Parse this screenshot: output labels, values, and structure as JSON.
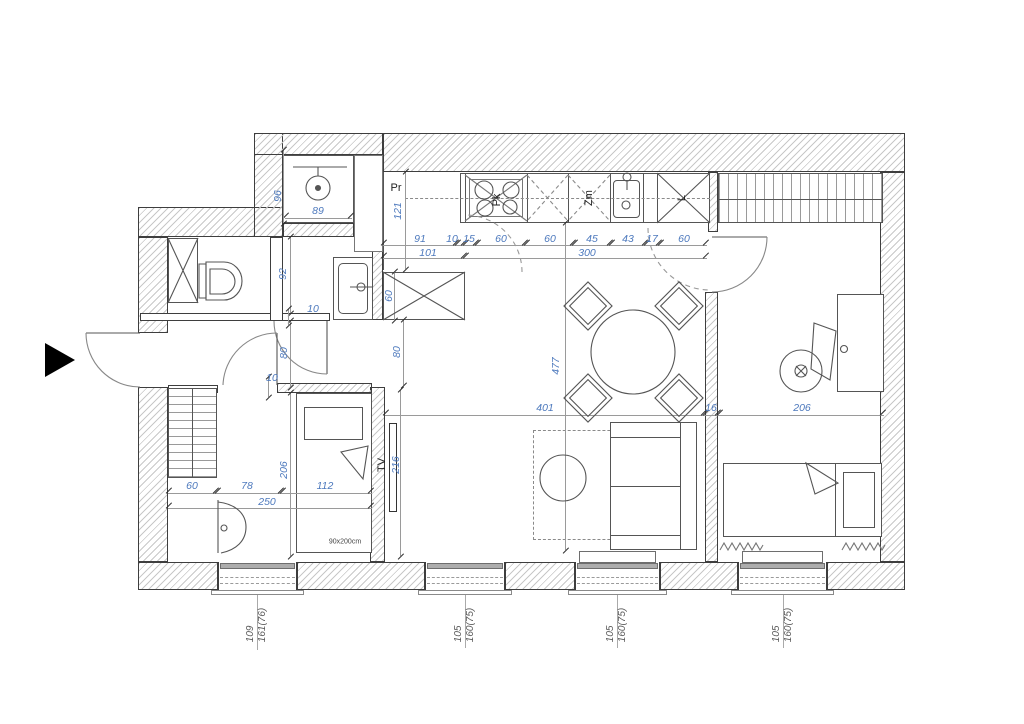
{
  "drawing": {
    "type": "apartment floor plan",
    "bed_size_label": "90x200cm"
  },
  "colors": {
    "dimension_text": "#4d79bd",
    "wall_outline": "#3e3e3e",
    "hatch": "#c8c8c8",
    "window_label_text": "#5a5a5a"
  },
  "annotations": [
    {
      "n": "dim-shower-height",
      "t": "96",
      "x": 278,
      "y": 196,
      "r": 1,
      "c": "b"
    },
    {
      "n": "dim-shower-width",
      "t": "89",
      "x": 318,
      "y": 211,
      "r": 0,
      "c": "b"
    },
    {
      "n": "dim-wc-depth",
      "t": "92",
      "x": 283,
      "y": 274,
      "r": 1,
      "c": "b"
    },
    {
      "n": "dim-wall-10a",
      "t": "10",
      "x": 313,
      "y": 309,
      "r": 0,
      "c": "b"
    },
    {
      "n": "dim-door-80a",
      "t": "80",
      "x": 284,
      "y": 353,
      "r": 1,
      "c": "b"
    },
    {
      "n": "dim-door-80b",
      "t": "80",
      "x": 397,
      "y": 352,
      "r": 1,
      "c": "b"
    },
    {
      "n": "dim-wall-10b",
      "t": "10",
      "x": 272,
      "y": 378,
      "r": 0,
      "c": "b"
    },
    {
      "n": "dim-washer-depth",
      "t": "121",
      "x": 398,
      "y": 211,
      "r": 1,
      "c": "b"
    },
    {
      "n": "dim-k-91",
      "t": "91",
      "x": 420,
      "y": 239,
      "r": 0,
      "c": "b"
    },
    {
      "n": "dim-k-10",
      "t": "10",
      "x": 452,
      "y": 239,
      "r": 0,
      "c": "b"
    },
    {
      "n": "dim-k-15",
      "t": "15",
      "x": 469,
      "y": 239,
      "r": 0,
      "c": "b"
    },
    {
      "n": "dim-k-60a",
      "t": "60",
      "x": 501,
      "y": 239,
      "r": 0,
      "c": "b"
    },
    {
      "n": "dim-k-60b",
      "t": "60",
      "x": 550,
      "y": 239,
      "r": 0,
      "c": "b"
    },
    {
      "n": "dim-k-45",
      "t": "45",
      "x": 592,
      "y": 239,
      "r": 0,
      "c": "b"
    },
    {
      "n": "dim-k-43",
      "t": "43",
      "x": 628,
      "y": 239,
      "r": 0,
      "c": "b"
    },
    {
      "n": "dim-k-17",
      "t": "17",
      "x": 652,
      "y": 239,
      "r": 0,
      "c": "b"
    },
    {
      "n": "dim-k-60c",
      "t": "60",
      "x": 684,
      "y": 239,
      "r": 0,
      "c": "b"
    },
    {
      "n": "dim-k-101",
      "t": "101",
      "x": 428,
      "y": 253,
      "r": 0,
      "c": "b"
    },
    {
      "n": "dim-k-300",
      "t": "300",
      "x": 587,
      "y": 253,
      "r": 0,
      "c": "b"
    },
    {
      "n": "dim-cabinet-60",
      "t": "60",
      "x": 389,
      "y": 296,
      "r": 1,
      "c": "b"
    },
    {
      "n": "dim-living-477",
      "t": "477",
      "x": 556,
      "y": 366,
      "r": 1,
      "c": "b"
    },
    {
      "n": "dim-living-401",
      "t": "401",
      "x": 545,
      "y": 408,
      "r": 0,
      "c": "b"
    },
    {
      "n": "dim-wall-16",
      "t": "16",
      "x": 711,
      "y": 408,
      "r": 0,
      "c": "b"
    },
    {
      "n": "dim-room-206",
      "t": "206",
      "x": 802,
      "y": 408,
      "r": 0,
      "c": "b"
    },
    {
      "n": "dim-bed-206",
      "t": "206",
      "x": 284,
      "y": 470,
      "r": 1,
      "c": "b"
    },
    {
      "n": "dim-tvwall-216",
      "t": "216",
      "x": 396,
      "y": 465,
      "r": 1,
      "c": "b"
    },
    {
      "n": "dim-left-60",
      "t": "60",
      "x": 192,
      "y": 486,
      "r": 0,
      "c": "b"
    },
    {
      "n": "dim-left-78",
      "t": "78",
      "x": 247,
      "y": 486,
      "r": 0,
      "c": "b"
    },
    {
      "n": "dim-left-112",
      "t": "112",
      "x": 325,
      "y": 486,
      "r": 0,
      "c": "b"
    },
    {
      "n": "dim-left-250",
      "t": "250",
      "x": 267,
      "y": 502,
      "r": 0,
      "c": "b"
    },
    {
      "n": "label-washing-machine",
      "t": "Pr",
      "x": 396,
      "y": 188,
      "r": 0,
      "c": "k"
    },
    {
      "n": "label-hob",
      "t": "Pk",
      "x": 497,
      "y": 200,
      "r": 1,
      "c": "k"
    },
    {
      "n": "label-dishwasher",
      "t": "Zm",
      "x": 589,
      "y": 198,
      "r": 1,
      "c": "k"
    },
    {
      "n": "label-fridge",
      "t": "L",
      "x": 682,
      "y": 198,
      "r": 1,
      "c": "k"
    },
    {
      "n": "label-tv",
      "t": "TV",
      "x": 382,
      "y": 465,
      "r": 1,
      "c": "k"
    },
    {
      "n": "label-bed-size",
      "t": "90x200cm",
      "x": 345,
      "y": 542,
      "r": 0,
      "c": "s"
    }
  ],
  "windows": [
    {
      "n": "window-1",
      "x1": 218,
      "x2": 297,
      "cx": 257,
      "line1": "109",
      "line2": "161(76)"
    },
    {
      "n": "window-2",
      "x1": 425,
      "x2": 505,
      "cx": 465,
      "line1": "105",
      "line2": "160(75)"
    },
    {
      "n": "window-3",
      "x1": 575,
      "x2": 660,
      "cx": 617,
      "line1": "105",
      "line2": "160(75)"
    },
    {
      "n": "window-4",
      "x1": 738,
      "x2": 827,
      "cx": 783,
      "line1": "105",
      "line2": "160(75)"
    }
  ],
  "dim_lines": [
    {
      "o": "h",
      "x1": 383,
      "x2": 457,
      "y": 245
    },
    {
      "o": "h",
      "x1": 457,
      "x2": 465,
      "y": 245
    },
    {
      "o": "h",
      "x1": 465,
      "x2": 477,
      "y": 245
    },
    {
      "o": "h",
      "x1": 477,
      "x2": 526,
      "y": 245
    },
    {
      "o": "h",
      "x1": 526,
      "x2": 574,
      "y": 245
    },
    {
      "o": "h",
      "x1": 574,
      "x2": 611,
      "y": 245
    },
    {
      "o": "h",
      "x1": 611,
      "x2": 646,
      "y": 245
    },
    {
      "o": "h",
      "x1": 646,
      "x2": 660,
      "y": 245
    },
    {
      "o": "h",
      "x1": 660,
      "x2": 707,
      "y": 245
    },
    {
      "o": "h",
      "x1": 383,
      "x2": 465,
      "y": 258
    },
    {
      "o": "h",
      "x1": 465,
      "x2": 707,
      "y": 258
    },
    {
      "o": "h",
      "x1": 285,
      "x2": 352,
      "y": 218
    },
    {
      "o": "h",
      "x1": 385,
      "x2": 705,
      "y": 415
    },
    {
      "o": "h",
      "x1": 705,
      "x2": 719,
      "y": 415
    },
    {
      "o": "h",
      "x1": 719,
      "x2": 884,
      "y": 415
    },
    {
      "o": "h",
      "x1": 168,
      "x2": 217,
      "y": 493
    },
    {
      "o": "h",
      "x1": 217,
      "x2": 282,
      "y": 493
    },
    {
      "o": "h",
      "x1": 282,
      "x2": 372,
      "y": 493
    },
    {
      "o": "h",
      "x1": 168,
      "x2": 372,
      "y": 508
    },
    {
      "o": "v",
      "y1": 172,
      "y2": 269,
      "x": 405
    },
    {
      "o": "v",
      "y1": 237,
      "y2": 313,
      "x": 290
    },
    {
      "o": "v",
      "y1": 321,
      "y2": 387,
      "x": 290
    },
    {
      "o": "v",
      "y1": 320,
      "y2": 385,
      "x": 403
    },
    {
      "o": "v",
      "y1": 223,
      "y2": 550,
      "x": 565
    },
    {
      "o": "v",
      "y1": 393,
      "y2": 556,
      "x": 290
    },
    {
      "o": "v",
      "y1": 390,
      "y2": 556,
      "x": 400
    },
    {
      "o": "v",
      "y1": 150,
      "y2": 223,
      "x": 283
    },
    {
      "o": "v",
      "y1": 272,
      "y2": 320,
      "x": 394
    },
    {
      "o": "v",
      "y1": 309,
      "y2": 325,
      "x": 288
    },
    {
      "o": "v",
      "y1": 377,
      "y2": 397,
      "x": 268
    }
  ],
  "ext_lines": [
    {
      "x": 257,
      "y1": 571,
      "y2": 650
    },
    {
      "x": 465,
      "y1": 571,
      "y2": 648
    },
    {
      "x": 617,
      "y1": 571,
      "y2": 648
    },
    {
      "x": 783,
      "y1": 571,
      "y2": 648
    }
  ]
}
